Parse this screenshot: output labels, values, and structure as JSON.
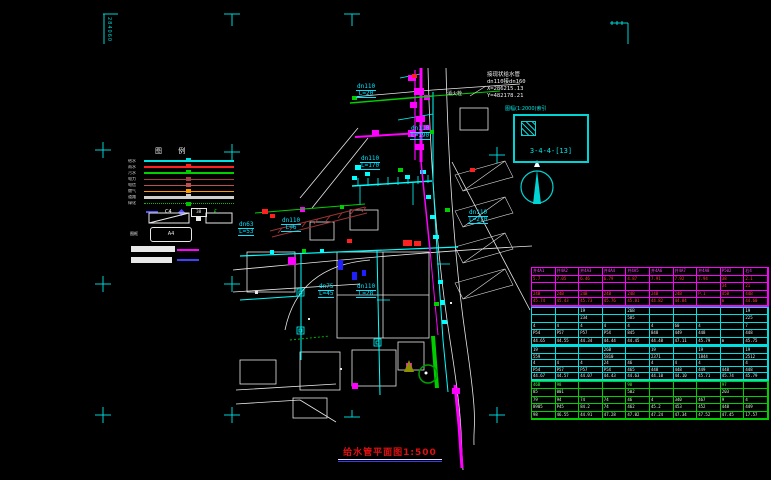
{
  "title": {
    "text": "给水管平面图1:500"
  },
  "corner_label": {
    "text": "284060"
  },
  "index_box": {
    "label": "图幅(1:2000)索引",
    "code": "3-4-4-[13]"
  },
  "annotation": {
    "lines": [
      "接现状给水管",
      "dn110接dn160",
      "X=286215.13",
      "Y=482178.21"
    ]
  },
  "colors": {
    "pipe_new": "#ff00ff",
    "pipe_existing": "#00ffff",
    "road": "#e8e8e8",
    "green": "#00c000",
    "title_red": "#e01010",
    "mark_cyan": "#00d5d5"
  },
  "legend": {
    "header": "图 例",
    "rows": [
      {
        "label": "给水",
        "color": "#00e0e0",
        "style": "solid2"
      },
      {
        "label": "雨水",
        "color": "#ff2020",
        "style": "solid2"
      },
      {
        "label": "污水",
        "color": "#00d000",
        "style": "solid2"
      },
      {
        "label": "电力",
        "color": "#a04040",
        "style": "solid1"
      },
      {
        "label": "电信",
        "color": "#c05050",
        "style": "solid1"
      },
      {
        "label": "燃气",
        "color": "#ff9900",
        "style": "solid1"
      },
      {
        "label": "道路",
        "color": "#cfcfcf",
        "style": "thick"
      },
      {
        "label": "绿化",
        "color": "#00c000",
        "style": "dotted"
      }
    ],
    "symbols": [
      {
        "type": "dash",
        "color": "#5050ff",
        "text": ""
      },
      {
        "type": "text",
        "color": "#ffffff",
        "text": "C4"
      },
      {
        "type": "diamond",
        "color": "#5050ff",
        "text": ""
      },
      {
        "type": "box",
        "color": "#ffffff",
        "text": "38"
      },
      {
        "type": "text",
        "color": "#00ff00",
        "text": "£"
      }
    ],
    "name_label": "图框",
    "box_text": "A4"
  },
  "map": {
    "pipe_labels": [
      {
        "text": "dn110",
        "sub": "L=20",
        "x": 356,
        "y": 84
      },
      {
        "text": "dn110",
        "sub": "L=190",
        "x": 410,
        "y": 126
      },
      {
        "text": "dn110",
        "sub": "L=170",
        "x": 360,
        "y": 156
      },
      {
        "text": "dn63",
        "sub": "L=53",
        "x": 238,
        "y": 222
      },
      {
        "text": "dn110",
        "sub": "L=6",
        "x": 281,
        "y": 218
      },
      {
        "text": "dn110",
        "sub": "L=270",
        "x": 468,
        "y": 210
      },
      {
        "text": "dn75",
        "sub": "L=45",
        "x": 318,
        "y": 284
      },
      {
        "text": "dn110",
        "sub": "L=28",
        "x": 356,
        "y": 284
      }
    ],
    "white_labels": [
      {
        "text": "消火栓",
        "x": 447,
        "y": 90
      }
    ]
  },
  "table": {
    "sections": [
      {
        "top": 267,
        "height": 40,
        "color": "#ff00ff",
        "row_colors": [
          "#ff40ff",
          "#ff4040",
          "#ff4040",
          "#ff4040",
          "#ff4040"
        ],
        "rows": [
          [
            "井4A1",
            "井4A2",
            "井4A3",
            "井4A4",
            "井4A5",
            "井4A6",
            "井4A7",
            "井4A8",
            "P502",
            "右4"
          ],
          [
            "5.7",
            "7.05",
            "6.46",
            "6.79",
            "4.87",
            "7.91",
            "7.92",
            "7.94",
            "38",
            "2.1"
          ],
          [
            "",
            "",
            "",
            "",
            "",
            "",
            "",
            "",
            "34",
            "21"
          ],
          [
            "24B",
            "24B",
            "24B",
            "24B",
            "24B",
            "24B",
            "24B",
            "P.1",
            "45B",
            "44B"
          ],
          [
            "45.74",
            "45.43",
            "45.73",
            "45.76",
            "45.81",
            "44.82",
            "44.84",
            "",
            "m",
            "44.60"
          ]
        ]
      },
      {
        "top": 307,
        "height": 39,
        "color": "#00e0e0",
        "row_colors": [
          "#bfffff",
          "#e8e8e8",
          "#e8e8e8",
          "#e8e8e8",
          "#e8e8e8"
        ],
        "rows": [
          [
            "",
            "",
            "19",
            "",
            "26B",
            "",
            "",
            "",
            "",
            "19"
          ],
          [
            "",
            "",
            "234",
            "",
            "585",
            "",
            "",
            "",
            "",
            "225"
          ],
          [
            "4",
            "4",
            "4",
            "4",
            "4",
            "4",
            "60",
            "4",
            "",
            "7"
          ],
          [
            "P54",
            "P57",
            "P57",
            "P5X",
            "845",
            "848",
            "449",
            "448",
            "",
            "448"
          ],
          [
            "44.65",
            "44.55",
            "44.34",
            "44.44",
            "44.45",
            "44.48",
            "47.11",
            "45.79",
            "m",
            "45.75"
          ]
        ]
      },
      {
        "top": 346,
        "height": 35,
        "color": "#00e0e0",
        "row_colors": [
          "#bfffff",
          "#e8e8e8",
          "#e8e8e8",
          "#e8e8e8",
          "#e8e8e8"
        ],
        "rows": [
          [
            "19",
            "",
            "",
            "26B",
            "",
            "19",
            "",
            "19",
            "",
            "19"
          ],
          [
            "559",
            "",
            "",
            "5810",
            "",
            "2371",
            "",
            "1844",
            "",
            "2512"
          ],
          [
            "4",
            "4",
            "4",
            "24",
            "46",
            "4",
            "4",
            "4",
            "",
            "4"
          ],
          [
            "P54",
            "P57",
            "P57",
            "P5X",
            "465",
            "448",
            "448",
            "449",
            "448",
            "448"
          ],
          [
            "44.67",
            "44.57",
            "44.07",
            "44.43",
            "44.63",
            "44.10",
            "44.10",
            "45.71",
            "45.74",
            "45.79"
          ]
        ]
      },
      {
        "top": 381,
        "height": 39,
        "color": "#00d000",
        "row_colors": [
          "#40ff40",
          "#d0ffd0",
          "#d0ffd0",
          "#d0ffd0",
          "#d0ffd0"
        ],
        "rows": [
          [
            "46B",
            "98",
            "",
            "",
            "98",
            "",
            "",
            "",
            "97",
            ""
          ],
          [
            "85",
            "001",
            "",
            "",
            "502",
            "",
            "",
            "",
            "203",
            ""
          ],
          [
            "79",
            "94",
            "74",
            "74",
            "46",
            "4",
            "340",
            "467",
            "9",
            "4"
          ],
          [
            "8905",
            "P45",
            "84.2",
            "74",
            "462",
            "45.2",
            "453",
            "452",
            "448",
            "449"
          ],
          [
            "98",
            "46.55",
            "44.91",
            "47.28",
            "47.02",
            "47.24",
            "47.34",
            "47.52",
            "47.45",
            "17.57"
          ]
        ]
      }
    ]
  }
}
